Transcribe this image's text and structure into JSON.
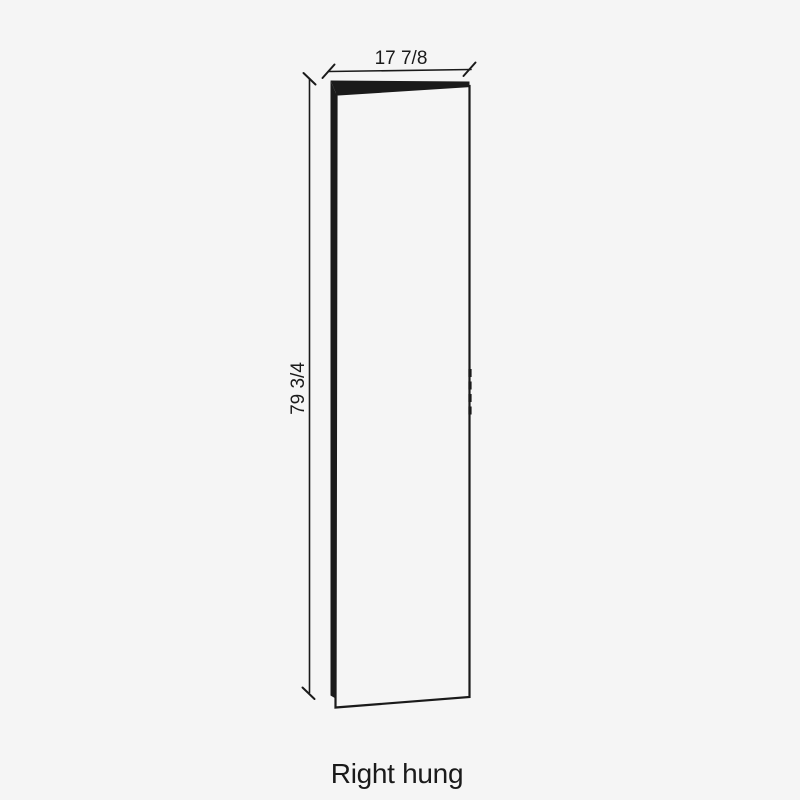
{
  "canvas": {
    "background": "#f5f5f5",
    "ink": "#1a1a1a"
  },
  "diagram": {
    "type": "door-elevation-drawing",
    "width_label": "17 7/8",
    "height_label": "79 3/4",
    "caption": "Right hung"
  }
}
